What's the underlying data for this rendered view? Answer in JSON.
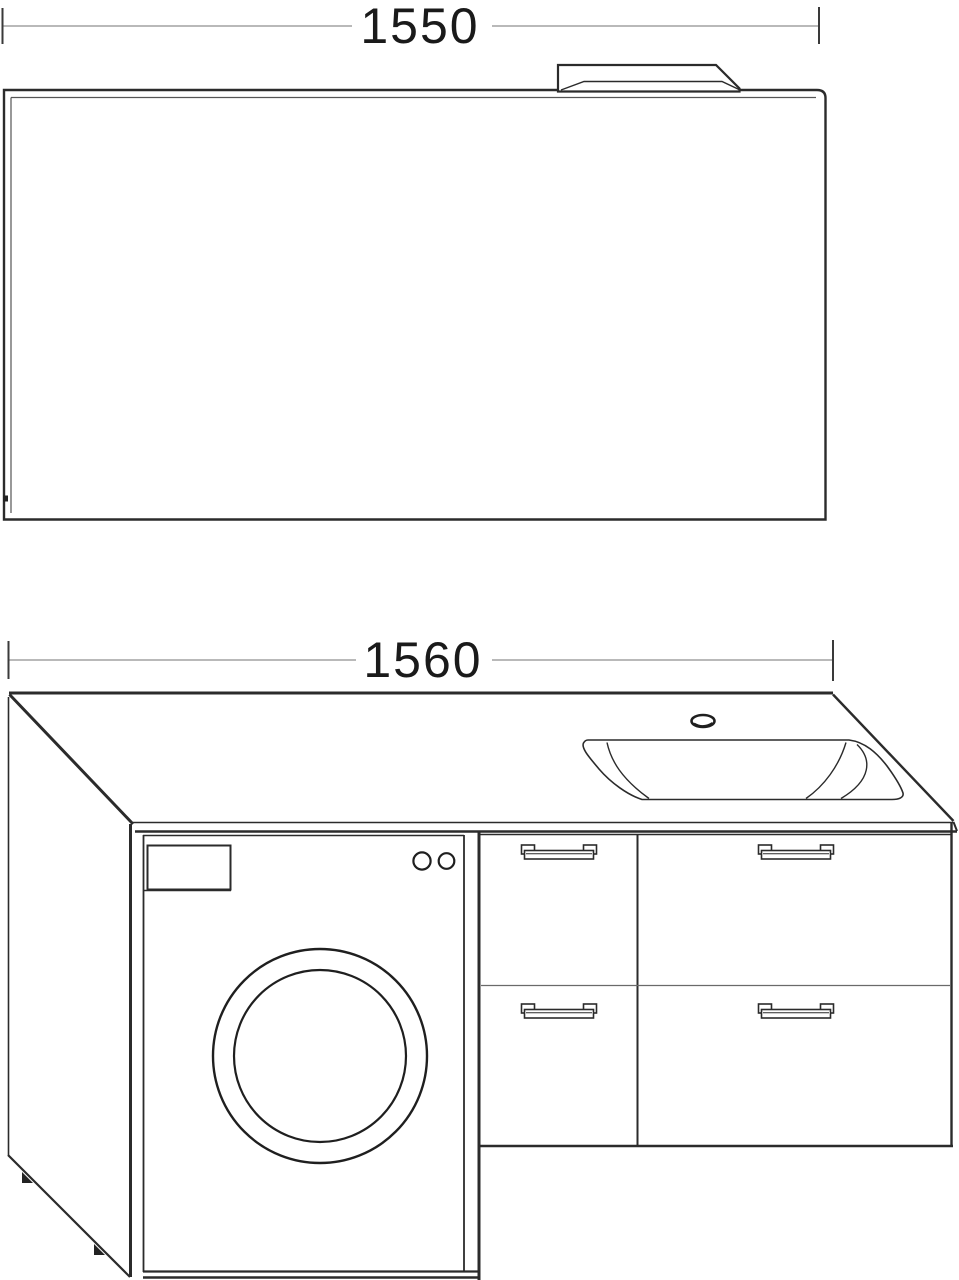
{
  "page": {
    "background": "#ffffff"
  },
  "drawing": {
    "line_color": "#2b2b2b",
    "thin_line_color": "#555555",
    "dim_line_color": "#8f8f8f",
    "text_color": "#1a1a1a",
    "mirror": {
      "width_label": "1550"
    },
    "vanity": {
      "width_label": "1560"
    },
    "components": [
      "mirror",
      "light-fixture",
      "countertop",
      "sink-basin",
      "faucet-hole",
      "left-side-panel",
      "washing-machine",
      "washing-machine-door",
      "detergent-drawer",
      "control-knobs",
      "drawer-unit",
      "drawer-handles"
    ]
  }
}
